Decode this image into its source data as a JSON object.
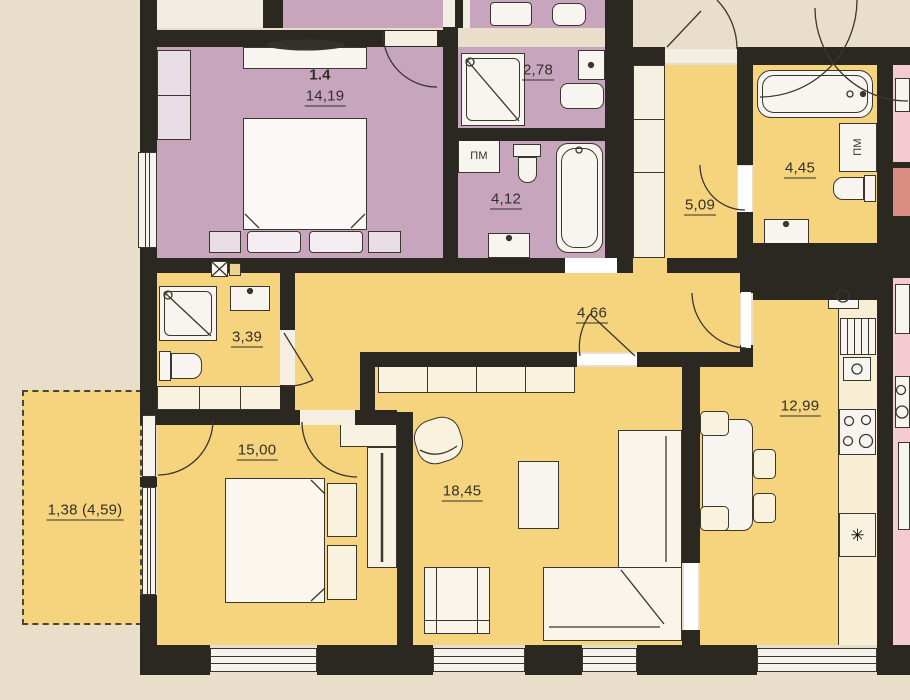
{
  "plan": {
    "neighbor_unit_label": "1.4",
    "rooms": {
      "neighbor_bedroom": {
        "area": "14,19"
      },
      "neighbor_shower": {
        "area": "2,78"
      },
      "neighbor_bath": {
        "area": "4,12"
      },
      "hall": {
        "area": "5,09"
      },
      "bathroom": {
        "area": "4,45"
      },
      "shower_room": {
        "area": "3,39"
      },
      "corridor": {
        "area": "4,66"
      },
      "kitchen": {
        "area": "12,99"
      },
      "bedroom": {
        "area": "15,00"
      },
      "living_room": {
        "area": "18,45"
      },
      "balcony": {
        "area": "1,38 (4,59)"
      }
    },
    "labels": {
      "washing_machine": "ПМ",
      "fridge": "✳"
    },
    "colors": {
      "main_unit_fill": "#f6d47d",
      "neighbor_unit_fill": "#c6a5bd",
      "adjacent_unit_fill": "#f3cbd1",
      "wall": "#2b2822",
      "background": "#e9dec9"
    }
  }
}
